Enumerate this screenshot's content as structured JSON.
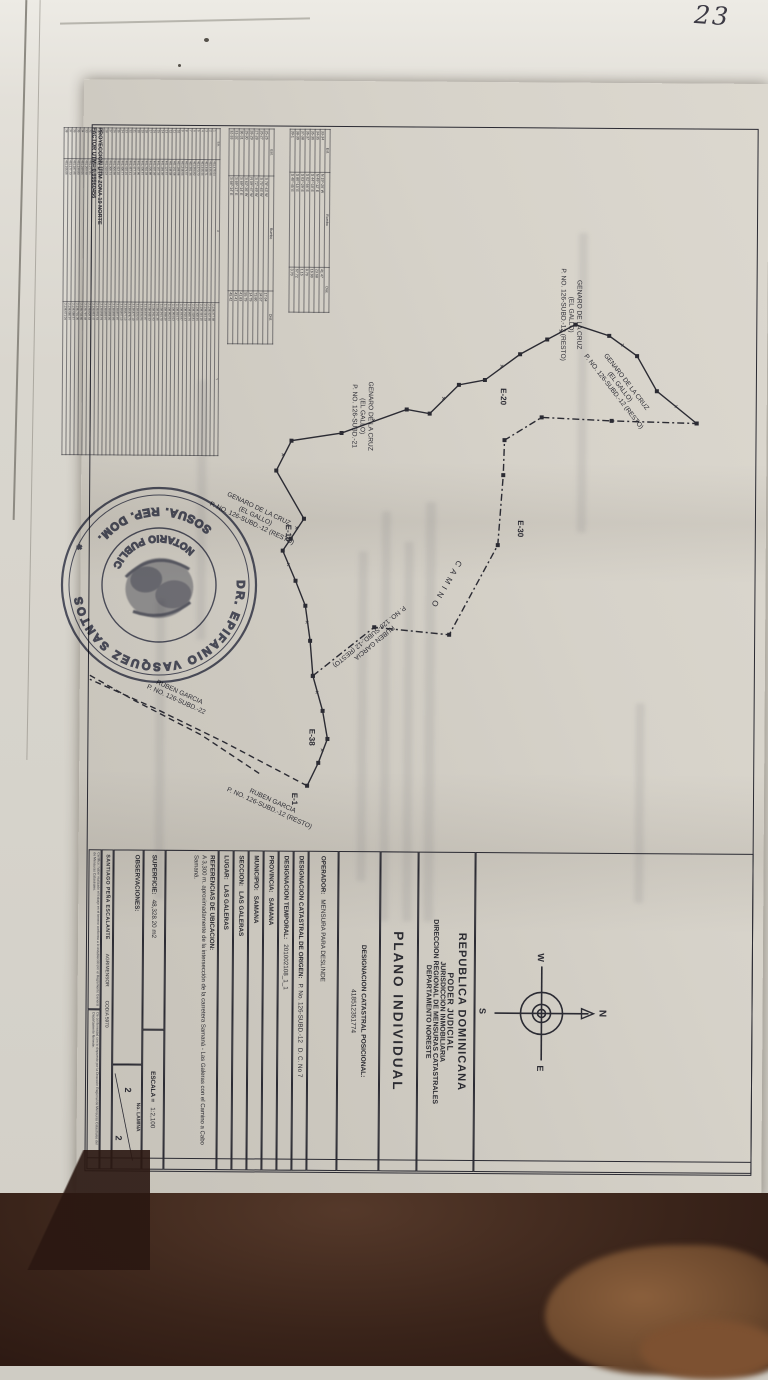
{
  "photo": {
    "handwritten_note": "23"
  },
  "sheet": {
    "projection_header": {
      "line1": "PROYECCION UTM ZONA 19 NORTE",
      "line2": "FACTOR UTM= 0.99960456"
    },
    "coord_table": {
      "columns": [
        "Est.",
        "X",
        "Y"
      ],
      "rows": [
        [
          "1",
          "461,475.64",
          "2,138,377.68"
        ],
        [
          "2",
          "461,446.95",
          "2,138,407.65"
        ],
        [
          "3",
          "461,448.71",
          "2,138,444.33"
        ],
        [
          "4",
          "461,446.44",
          "2,138,444.15"
        ],
        [
          "5",
          "461,373.73",
          "2,138,400.46"
        ],
        [
          "6",
          "461,354.82",
          "2,138,418.81"
        ],
        [
          "7",
          "461,301.36",
          "2,138,865.76"
        ],
        [
          "8",
          "461,274.57",
          "2,138,910.43"
        ],
        [
          "9",
          "461,248.66",
          "2,138,933.97"
        ],
        [
          "10",
          "461,188.98",
          "2,138,924.77"
        ],
        [
          "11",
          "461,161.68",
          "2,138,954.63"
        ],
        [
          "12",
          "461,148.08",
          "2,138,952.64"
        ],
        [
          "13",
          "461,127.57",
          "2,138,938.29"
        ],
        [
          "14",
          "461,184.09",
          "2,138,944.70"
        ],
        [
          "15",
          "461,167.33",
          "2,138,941.35"
        ],
        [
          "16",
          "461,207.09",
          "2,138,941.93"
        ],
        [
          "17",
          "461,220.88",
          "2,138,945.43"
        ],
        [
          "18",
          "461,310.03",
          "2,138,937.87"
        ],
        [
          "19",
          "461,435.57",
          "2,138,934.94"
        ],
        [
          "20",
          "461,467.95",
          "2,138,924.64"
        ],
        [
          "21",
          "461,477.75",
          "2,138,877.10"
        ],
        [
          "22",
          "461,457.41",
          "2,138,878.73"
        ],
        [
          "23",
          "461,415.16",
          "2,138,877.13"
        ],
        [
          "24",
          "461,405.77",
          "2,138,867.13"
        ],
        [
          "25",
          "461,413.10",
          "2,138,857.87"
        ],
        [
          "26",
          "461,306.98",
          "2,138,859.85"
        ],
        [
          "27",
          "461,305.74",
          "2,138,858.06"
        ],
        [
          "28",
          "461,310.03",
          "2,138,859.97"
        ],
        [
          "29",
          "461,308.32",
          "2,138,868.94"
        ],
        [
          "30",
          "461,301.37",
          "2,138,864.64"
        ],
        [
          "31",
          "461,289.45",
          "2,138,853.47"
        ],
        [
          "32",
          "461,277.81",
          "2,138,829.63"
        ],
        [
          "33",
          "461,259.98",
          "2,138,787.48"
        ],
        [
          "34",
          "461,249.06",
          "2,138,732.60"
        ],
        [
          "35",
          "461,239.80",
          "2,138,701.35"
        ],
        [
          "36",
          "461,187.95",
          "2,138,688.57"
        ],
        [
          "37",
          "461,177.73",
          "2,138,680.97"
        ],
        [
          "38",
          "461,166.05",
          "2,138,671.04"
        ]
      ]
    },
    "bearing_table_1": {
      "columns": [
        "Est.",
        "Rumbo",
        "Dist."
      ],
      "rows": [
        [
          "25-26",
          "S 78°-43' W",
          "17.64"
        ],
        [
          "26-27",
          "S 75°-45' W",
          "34.67"
        ],
        [
          "27-28",
          "S 72°-49' W",
          "73.80"
        ],
        [
          "28-29",
          "N 59°-47' W",
          "14.79"
        ],
        [
          "29-30",
          "S 63°-36' W",
          "55.79"
        ],
        [
          "30-31",
          "S 69°-14' E",
          "41.83"
        ],
        [
          "31-32",
          "S 69°-17' E",
          "43.41"
        ],
        [
          "32-33",
          "S 68°-14' E",
          "45.42"
        ]
      ]
    },
    "bearing_table_2": {
      "columns": [
        "Est.",
        "Rumbo",
        "Dist."
      ],
      "rows": [
        [
          "33-34",
          "N 19°-26' W",
          "41.47"
        ],
        [
          "34-35",
          "N 49°-12' E",
          "23.68"
        ],
        [
          "35-36",
          "S 44°-10' E",
          "16.90"
        ],
        [
          "36-37",
          "S 02°-56' E",
          "8.70"
        ],
        [
          "37-38",
          "S 03°-29' E",
          "1.15"
        ],
        [
          "38-39",
          "S 80°-15' E",
          "67.72"
        ],
        [
          "39-1",
          "S 40°-45' E",
          "3.70"
        ]
      ]
    },
    "drawing": {
      "boundary_main": [
        [
          340,
          70
        ],
        [
          308,
          110
        ],
        [
          273,
          130
        ],
        [
          253,
          158
        ],
        [
          242,
          192
        ],
        [
          257,
          220
        ],
        [
          272,
          247
        ],
        [
          298,
          282
        ],
        [
          303,
          308
        ],
        [
          332,
          337
        ],
        [
          328,
          360
        ],
        [
          352,
          425
        ],
        [
          360,
          475
        ],
        [
          390,
          490
        ],
        [
          438,
          462
        ],
        [
          458,
          475
        ],
        [
          470,
          483
        ],
        [
          500,
          470
        ],
        [
          525,
          460
        ],
        [
          560,
          455
        ],
        [
          595,
          452
        ],
        [
          630,
          442
        ],
        [
          658,
          437
        ],
        [
          682,
          446
        ],
        [
          705,
          457
        ]
      ],
      "boundary_top": [
        [
          595,
          452
        ],
        [
          546,
          391
        ],
        [
          553,
          316
        ],
        [
          463,
          268
        ],
        [
          393,
          263
        ],
        [
          358,
          262
        ],
        [
          335,
          225
        ],
        [
          338,
          155
        ],
        [
          340,
          70
        ]
      ],
      "corridor_1": [
        [
          705,
          457
        ],
        [
          662,
          540
        ],
        [
          628,
          611
        ],
        [
          600,
          675
        ]
      ],
      "corridor_2": [
        [
          693,
          505
        ],
        [
          655,
          563
        ],
        [
          621,
          630
        ],
        [
          596,
          675
        ]
      ],
      "vertex_labels": [
        {
          "text": "E-20",
          "x": 306,
          "y": 266
        },
        {
          "text": "E-10",
          "x": 444,
          "y": 480
        },
        {
          "text": "E-30",
          "x": 438,
          "y": 248
        },
        {
          "text": "E-38",
          "x": 648,
          "y": 455
        },
        {
          "text": "E-1",
          "x": 712,
          "y": 472
        }
      ],
      "camino_label": {
        "text": "CAMINO",
        "x": 478,
        "y": 308,
        "rot": 30
      },
      "labels": [
        {
          "lines": [
            "GENARO DE LA CRUZ",
            "(EL GALLO)",
            "P. NO. 126-SUBD.-12 (RESTO)"
          ],
          "x": 232,
          "y": 190,
          "rot": 0
        },
        {
          "lines": [
            "GENARO DE LA CRUZ",
            "(EL GALLO)",
            "P. NO. 126-SUBD.-12 (RESTO)"
          ],
          "x": 300,
          "y": 142,
          "rot": -38
        },
        {
          "lines": [
            "GENARO DE LA CRUZ",
            "(EL GALLO)",
            "P. NO. 126-SUBD.-21"
          ],
          "x": 335,
          "y": 398,
          "rot": 0
        },
        {
          "lines": [
            "GENARO DE LA CRUZ",
            "(EL GALLO)",
            "P. NO. 126-SUBD.-12 (RESTO)"
          ],
          "x": 430,
          "y": 508,
          "rot": -65
        },
        {
          "lines": [
            "RUBEN GARCIA",
            "P. NO. 126-SUBD.-12 (RESTO)"
          ],
          "x": 560,
          "y": 392,
          "rot": 50
        },
        {
          "lines": [
            "RUBEN GARCIA",
            "P. NO. 126-SUBD.-12 (RESTO)"
          ],
          "x": 722,
          "y": 492,
          "rot": -66
        },
        {
          "lines": [
            "RUBEN GARCIA",
            "P. NO. 126-SUBD.-22"
          ],
          "x": 614,
          "y": 586,
          "rot": -66
        }
      ],
      "compass": {
        "n": "N",
        "s": "S",
        "e": "E",
        "w": "W"
      }
    },
    "title_block": {
      "header": [
        "REPUBLICA  DOMINICANA",
        "PODER  JUDICIAL",
        "JURISDICCION INMOBILIARIA",
        "DIRECCION REGIONAL DE MENSURAS CATASTRALES",
        "DEPARTAMENTO NORESTE"
      ],
      "plano_titulo": "PLANO INDIVIDUAL",
      "posicional": {
        "label": "DESIGNACION CATASTRAL POSICIONAL:",
        "value": "418512351774"
      },
      "operador": {
        "label": "OPERADOR:",
        "value": "MENSURA PARA DESLINDE"
      },
      "origen": {
        "label": "DESIGNACION CATASTRAL DE ORIGEN:",
        "value": "P. No. 126-SUBD.-12",
        "extra": "D. C. No 7"
      },
      "temporal": {
        "label": "DESIGNACION TEMPORAL:",
        "value": "201002108_1_1"
      },
      "provincia": {
        "label": "PROVINCIA:",
        "value": "SAMANA"
      },
      "municipio": {
        "label": "MUNICIPIO:",
        "value": "SAMANA"
      },
      "seccion": {
        "label": "SECCION:",
        "value": "LAS GALERAS"
      },
      "lugar": {
        "label": "LUGAR:",
        "value": "LAS GALERAS"
      },
      "referencias": {
        "label": "REFERENCIAS DE UBICACION:",
        "value": "A 3,300 m. aproximadamente de la intersección de la carretera Samaná - Las Galeras con el Camino a Cabo Samaná."
      },
      "superficie": {
        "label": "SUPERFICIE:",
        "value": "48,328.20 m2"
      },
      "escala": {
        "label": "ESCALA =",
        "value": "1:2,100"
      },
      "observaciones": {
        "label": "OBSERVACIONES:"
      },
      "lamina": {
        "label": "No. LAMINA",
        "a": "2",
        "b": "2"
      },
      "firmante": {
        "name": "SANTIAGO PEÑA ESCALANTE",
        "titulo": "AGRIMENSOR",
        "codia": "CODIA 5970"
      },
      "cert_1": "Certifico: haber realizado el trabajo en el terreno conforme a lo establecido por el Reglamento General de Mensuras Catastrales.",
      "cert_2": "De conformidad con lo dispuesto por la Dirección Regional de Mensuras Catastrales del Departamento Noreste."
    },
    "stamp": {
      "outer_text": "DR. EPIFANIO VASQUEZ SANTOS",
      "bottom_text": "SOSUA. REP. DOM.",
      "inner_text": "NOTARIO PUBLICO",
      "star": "*",
      "ink_color": "#434760"
    }
  }
}
